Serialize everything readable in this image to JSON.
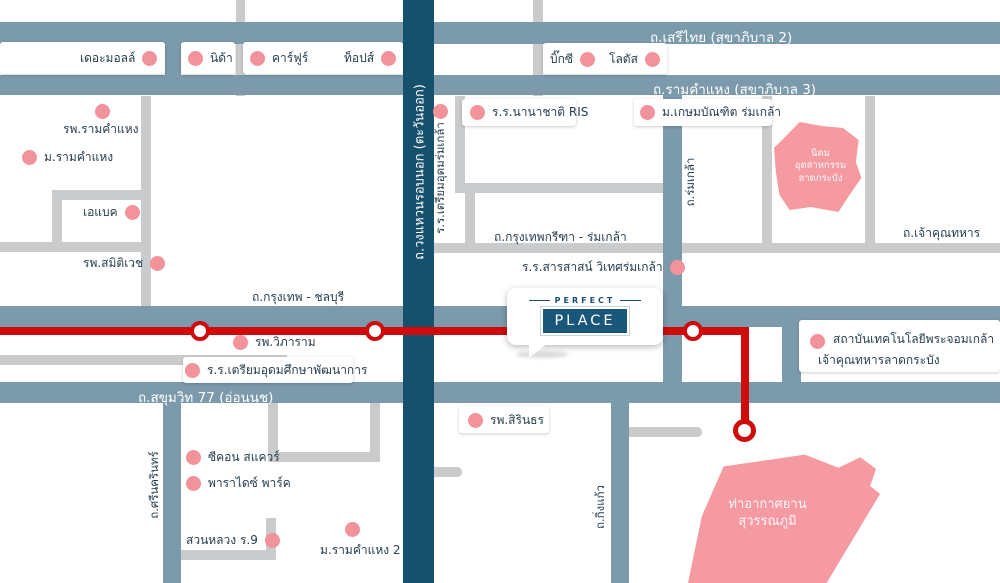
{
  "roads": {
    "serithai": "ถ.เสรีไทย (สุขาภิบาล 2)",
    "ramkhamhaeng": "ถ.รามคำแหง (สุขาภิบาล 3)",
    "outer_ring": "ถ.วงแหวนรอบนอก (ตะวันออก)",
    "krungthep_chonburi": "ถ.กรุงเทพ - ชลบุรี",
    "sukhumvit_77": "ถ.สุขุมวิท 77 (อ่อนนุช)",
    "krungthep_kreetha": "ถ.กรุงเทพกรีฑา - ร่มเกล้า",
    "chao_khun_thahan": "ถ.เจ้าคุณทหาร",
    "romklao": "ถ.ร่มเกล้า",
    "srinagarindra": "ถ.ศรีนครินทร์",
    "king_kaew": "ถ.กิ่งแก้ว"
  },
  "logo": {
    "top": "PERFECT",
    "main": "PLACE"
  },
  "areas": {
    "industrial_l1": "นิคม",
    "industrial_l2": "อุตสาหกรรม",
    "industrial_l3": "ลาดกระบัง",
    "airport_l1": "ท่าอากาศยาน",
    "airport_l2": "สุวรรณภูมิ"
  },
  "pois": {
    "the_mall": "เดอะมอลล์",
    "nida": "นิด้า",
    "carrefour": "คาร์ฟูร์",
    "tops": "ท็อปส์",
    "big_c": "บิ๊กซี",
    "lotus": "โลตัส",
    "ramkhamhaeng_hospital": "รพ.รามคำแหง",
    "ramkhamhaeng_university": "ม.รามคำแหง",
    "abac": "เอแบค",
    "samitivej_hospital": "รพ.สมิติเวช",
    "ris_school": "ร.ร.นานาชาติ RIS",
    "kasem_bundit": "ม.เกษมบัณฑิต ร่มเกล้า",
    "triam_udom_romklao": "ร.ร.เตรียมอุดมร่มเกล้า",
    "sarasas_school": "ร.ร.สารสาสน์ วิเทศร่มเกล้า",
    "vipharam_hospital": "รพ.วิภาราม",
    "triam_udom_pattanakarn": "ร.ร.เตรียมอุดมศึกษาพัฒนาการ",
    "sirindhorn_hospital": "รพ.สิรินธร",
    "kmitl_l1": "สถาบันเทคโนโลยีพระจอมเกล้า",
    "kmitl_l2": "เจ้าคุณทหารลาดกระบัง",
    "seacon_square": "ซีคอน สแควร์",
    "paradise_park": "พาราไดซ์ พาร์ค",
    "suan_luang": "สวนหลวง ร.9",
    "ramkhamhaeng_2": "ม.รามคำแหง 2"
  },
  "colors": {
    "road_blue": "#7b9aab",
    "ring_navy": "#15506d",
    "road_gray": "#c9cbcc",
    "route_red": "#cf0b0b",
    "poi_pink": "#f2939b",
    "area_pink": "#f59aa1",
    "label_dark": "#27404f"
  }
}
